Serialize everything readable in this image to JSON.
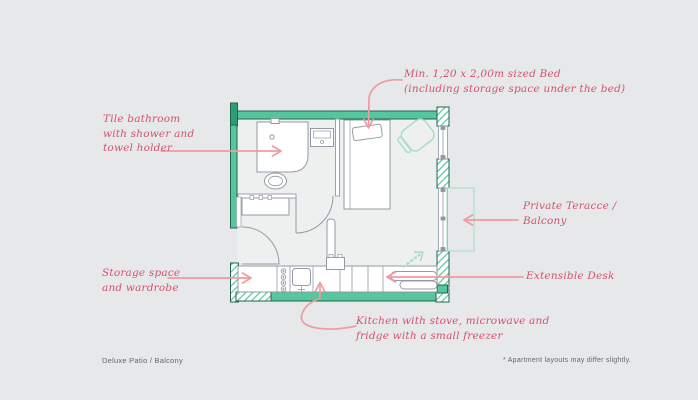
{
  "colors": {
    "background": "#e7e8e9",
    "wall_teal": "#55c69d",
    "wall_dark_accent": "#2f9c78",
    "wall_outline": "#23654c",
    "furniture_line": "#939aa4",
    "accent_mint": "#a5dbc8",
    "annotation_text": "#d4516f",
    "annotation_arrow": "#ef9ba1",
    "footer_text": "#63666d"
  },
  "annotations": {
    "bathroom": {
      "text": "Tile bathroom\nwith shower and\ntowel holder"
    },
    "bed": {
      "text": "Min. 1,20 x 2,00m sized Bed\n(including storage space under the bed)"
    },
    "terrace": {
      "text": "Private Teracce /\nBalcony"
    },
    "desk": {
      "text": "Extensible Desk"
    },
    "storage": {
      "text": "Storage space\nand wardrobe"
    },
    "kitchen": {
      "text": "Kitchen with stove, microwave and\nfridge with a small freezer"
    }
  },
  "footer": {
    "plan_name": "Deluxe Patio / Balcony",
    "disclaimer": "* Apartment layouts may differ slightly."
  },
  "floorplan": {
    "type": "studio-apartment-plan",
    "features": [
      "bathroom-shower",
      "toilet",
      "wash-basin",
      "towel-radiator",
      "bed-with-pillow",
      "armchair",
      "wardrobe",
      "stove",
      "kitchen-sink",
      "microwave",
      "extensible-desk",
      "private-terrace",
      "windows"
    ]
  }
}
